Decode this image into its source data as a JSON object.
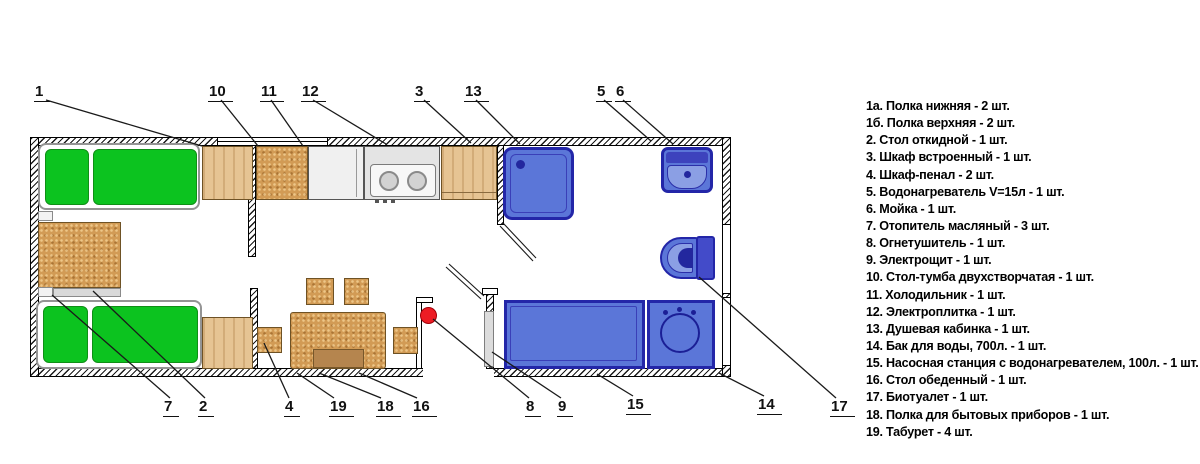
{
  "callouts": {
    "c1": "1",
    "c10": "10",
    "c11": "11",
    "c12": "12",
    "c3": "3",
    "c13": "13",
    "c5": "5",
    "c6": "6",
    "c7": "7",
    "c2": "2",
    "c4": "4",
    "c19": "19",
    "c18": "18",
    "c16": "16",
    "c8": "8",
    "c9": "9",
    "c15": "15",
    "c14": "14",
    "c17": "17"
  },
  "legend": {
    "items": [
      "1а. Полка нижняя - 2 шт.",
      "1б. Полка верхняя - 2 шт.",
      "2. Стол откидной - 1 шт.",
      "3. Шкаф встроенный - 1 шт.",
      "4. Шкаф-пенал - 2 шт.",
      "5. Водонагреватель V=15л - 1 шт.",
      "6. Мойка - 1 шт.",
      "7. Отопитель масляный - 3 шт.",
      "8. Огнетушитель - 1 шт.",
      "9. Электрощит - 1 шт.",
      "10. Стол-тумба двухстворчатая - 1 шт.",
      "11. Холодильник - 1 шт.",
      "12. Электроплитка - 1 шт.",
      "13. Душевая кабинка - 1 шт.",
      "14. Бак для воды, 700л. - 1 шт.",
      "15. Насосная станция с водонагревателем, 100л. - 1 шт.",
      "16. Стол обеденный - 1 шт.",
      "17. Биотуалет - 1 шт.",
      "18. Полка для бытовых приборов - 1 шт.",
      "19. Табурет - 4 шт."
    ]
  },
  "colors": {
    "mattress_green": "#0cc31f",
    "cork_tan": "#d29b55",
    "wood_light": "#e6c493",
    "fixture_blue": "#5b76d8",
    "fixture_blue_dark": "#2326a8",
    "fixture_blue_light": "#8b9fe4",
    "extinguisher_red": "#ed1c24",
    "wall_hatch": "#1a1a1a"
  }
}
